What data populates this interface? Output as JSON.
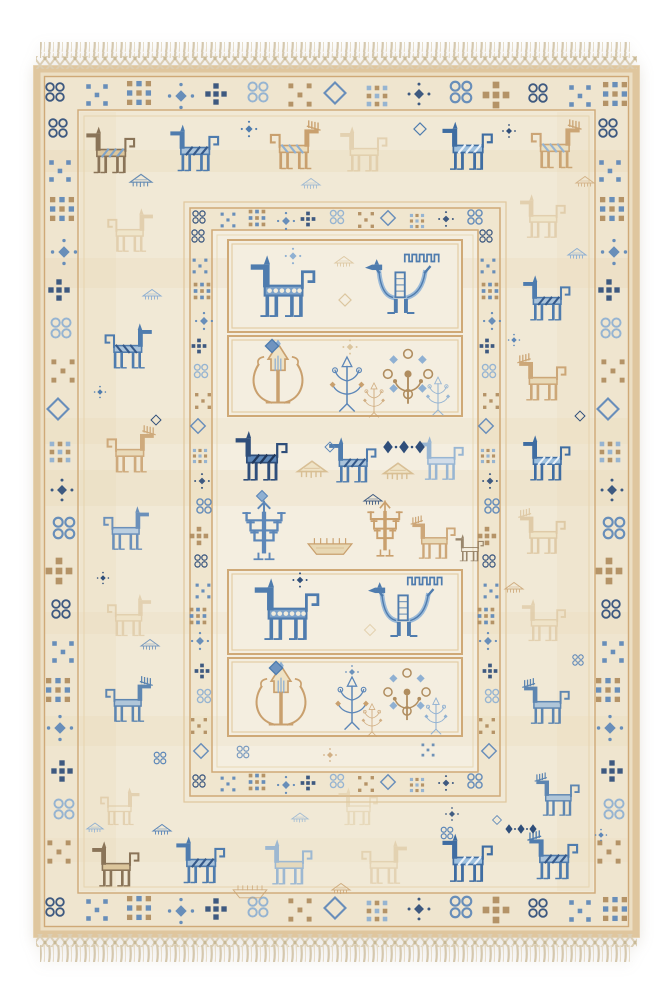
{
  "palette": {
    "page_bg": "#ffffff",
    "rug_edge_tan": "#dfc69e",
    "rug_base_cream": "#efe5cf",
    "band_cream": "#f1e9d6",
    "field_cream": "#f4eee0",
    "frame_tan": "#cfa977",
    "motif_tan": "#c9a06e",
    "motif_pale_tan": "#d6bb8e",
    "motif_brown": "#8a7458",
    "motif_navy": "#2f4e7a",
    "motif_blue": "#4f7cae",
    "motif_light_blue": "#8fb0d2",
    "fringe_cream": "#d8ccb4"
  },
  "canvas": {
    "w": 672,
    "h": 1000
  },
  "rug": {
    "x": 33,
    "y": 65,
    "w": 607,
    "h": 873,
    "fringe": {
      "top": {
        "tassel": [
          40,
          42,
          593,
          16
        ],
        "mesh": [
          36,
          56,
          601,
          13
        ]
      },
      "bottom": {
        "mesh": [
          36,
          934,
          601,
          13
        ],
        "tassel": [
          40,
          945,
          593,
          17
        ]
      }
    }
  },
  "bgs": [
    {
      "x": 33,
      "y": 65,
      "w": 607,
      "h": 873,
      "c": "#ecdfc4"
    },
    {
      "x": 45,
      "y": 77,
      "w": 583,
      "h": 849,
      "c": "#efe5cf"
    },
    {
      "x": 78,
      "y": 110,
      "w": 517,
      "h": 783,
      "c": "#f1e9d6"
    },
    {
      "x": 190,
      "y": 208,
      "w": 310,
      "h": 588,
      "c": "#f0e6cf"
    },
    {
      "x": 212,
      "y": 230,
      "w": 266,
      "h": 542,
      "c": "#f4eee0"
    }
  ],
  "textures": [
    {
      "x": 45,
      "y": 150,
      "w": 583,
      "h": 22,
      "c": "#e2cda2",
      "o": 0.18
    },
    {
      "x": 45,
      "y": 258,
      "w": 583,
      "h": 30,
      "c": "#e6d3ab",
      "o": 0.22
    },
    {
      "x": 45,
      "y": 418,
      "w": 583,
      "h": 26,
      "c": "#e2cda2",
      "o": 0.15
    },
    {
      "x": 45,
      "y": 470,
      "w": 583,
      "h": 36,
      "c": "#e6d3ab",
      "o": 0.2
    },
    {
      "x": 45,
      "y": 612,
      "w": 583,
      "h": 22,
      "c": "#e9d8b5",
      "o": 0.2
    },
    {
      "x": 45,
      "y": 716,
      "w": 583,
      "h": 30,
      "c": "#e6d3ab",
      "o": 0.16
    },
    {
      "x": 45,
      "y": 838,
      "w": 583,
      "h": 24,
      "c": "#e9d8b5",
      "o": 0.18
    },
    {
      "x": 80,
      "y": 112,
      "w": 36,
      "h": 779,
      "c": "#e9d7b2",
      "o": 0.22
    },
    {
      "x": 557,
      "y": 112,
      "w": 36,
      "h": 779,
      "c": "#e9d7b2",
      "o": 0.2
    }
  ],
  "frames": [
    {
      "x": 37,
      "y": 69,
      "w": 599,
      "h": 865,
      "stroke": "#dfc69e",
      "sw": 7
    },
    {
      "x": 44.5,
      "y": 76.5,
      "w": 584,
      "h": 850,
      "stroke": "#cfa977",
      "sw": 1.4
    },
    {
      "x": 78,
      "y": 110,
      "w": 517,
      "h": 783,
      "stroke": "#cfa977",
      "sw": 1.4
    },
    {
      "x": 84,
      "y": 116,
      "w": 505,
      "h": 771,
      "stroke": "#e6d3ae",
      "sw": 1
    },
    {
      "x": 184,
      "y": 202,
      "w": 322,
      "h": 600,
      "stroke": "#e0c79c",
      "sw": 1.2
    },
    {
      "x": 190,
      "y": 208,
      "w": 310,
      "h": 588,
      "stroke": "#cfa977",
      "sw": 1.5
    },
    {
      "x": 212,
      "y": 230,
      "w": 266,
      "h": 542,
      "stroke": "#cfa977",
      "sw": 1.5
    },
    {
      "x": 217,
      "y": 235,
      "w": 256,
      "h": 532,
      "stroke": "#e8d8b4",
      "sw": 1
    }
  ],
  "panels": [
    {
      "x": 228,
      "y": 240,
      "w": 234,
      "h": 92
    },
    {
      "x": 228,
      "y": 336,
      "w": 234,
      "h": 80
    },
    {
      "x": 228,
      "y": 570,
      "w": 234,
      "h": 84
    },
    {
      "x": 228,
      "y": 658,
      "w": 234,
      "h": 78
    }
  ],
  "panelStyle": {
    "fill": "#f4eee0",
    "stroke": "#cfa977",
    "inner": "#e3cda4"
  },
  "geoSequence": [
    {
      "t": "circles4",
      "c": "#2f4e7a"
    },
    {
      "t": "xdots",
      "c": "#5d87b8"
    },
    {
      "t": "grid9",
      "c": "#b08d5f",
      "c3": "#5d87b8"
    },
    {
      "t": "star",
      "c": "#5d87b8"
    },
    {
      "t": "cross5",
      "c": "#2f4e7a"
    },
    {
      "t": "circles4",
      "c": "#8fb0d2"
    },
    {
      "t": "xdots",
      "c": "#b08d5f"
    },
    {
      "t": "diamond",
      "c": "#5d87b8"
    },
    {
      "t": "grid9",
      "c": "#8fb0d2",
      "c3": "#b08d5f"
    },
    {
      "t": "star",
      "c": "#2f4e7a"
    },
    {
      "t": "circles4",
      "c": "#5d87b8"
    },
    {
      "t": "cross5",
      "c": "#b08d5f"
    }
  ],
  "geoBands": [
    {
      "name": "outer-top",
      "orient": "h",
      "y": 94,
      "x0": 58,
      "x1": 620,
      "step": 40,
      "s": 0.9
    },
    {
      "name": "outer-bottom",
      "orient": "h",
      "y": 909,
      "x0": 58,
      "x1": 620,
      "step": 40,
      "s": 0.9
    },
    {
      "name": "outer-left",
      "orient": "v",
      "x": 61,
      "y0": 130,
      "y1": 886,
      "step": 40,
      "s": 0.9
    },
    {
      "name": "outer-right",
      "orient": "v",
      "x": 611,
      "y0": 130,
      "y1": 886,
      "step": 40,
      "s": 0.9
    },
    {
      "name": "inner-top",
      "orient": "h",
      "y": 219,
      "x0": 202,
      "x1": 490,
      "step": 27,
      "s": 0.62
    },
    {
      "name": "inner-bottom",
      "orient": "h",
      "y": 783,
      "x0": 202,
      "x1": 490,
      "step": 27,
      "s": 0.62
    },
    {
      "name": "inner-left",
      "orient": "v",
      "x": 201,
      "y0": 238,
      "y1": 766,
      "step": 27,
      "s": 0.62
    },
    {
      "name": "inner-right",
      "orient": "v",
      "x": 489,
      "y0": 238,
      "y1": 766,
      "step": 27,
      "s": 0.62
    }
  ],
  "motifs": [
    {
      "t": "horse",
      "x": 113,
      "y": 152,
      "s": 0.62,
      "c1": "#8a7458",
      "c2": "#dcc69c",
      "c3": "#7fa3c8"
    },
    {
      "t": "horse",
      "x": 197,
      "y": 150,
      "s": 0.62,
      "c1": "#4f7cae",
      "c2": "#aac3da",
      "c3": "#35598a"
    },
    {
      "t": "deer",
      "x": 292,
      "y": 148,
      "s": 0.62,
      "flip": true,
      "c1": "#c9a06e",
      "c2": "#ecdcba",
      "c3": "#8fb0d2"
    },
    {
      "t": "horse",
      "x": 366,
      "y": 151,
      "s": 0.6,
      "c1": "#d9bf94",
      "c2": "#f0e3c4",
      "o": 0.55
    },
    {
      "t": "horse",
      "x": 470,
      "y": 148,
      "s": 0.64,
      "c1": "#3f6da2",
      "c2": "#9ec0de",
      "c3": "#eaf1f7"
    },
    {
      "t": "deer",
      "x": 553,
      "y": 147,
      "s": 0.62,
      "flip": true,
      "c1": "#c9a06e",
      "c2": "#eadfc0",
      "c3": "#8fb0d2",
      "o": 0.92
    },
    {
      "t": "awning",
      "x": 141,
      "y": 181,
      "s": 0.6,
      "c1": "#4f7cae",
      "o": 0.85
    },
    {
      "t": "star",
      "x": 249,
      "y": 129,
      "s": 0.6,
      "c1": "#4f7cae"
    },
    {
      "t": "awning",
      "x": 311,
      "y": 184,
      "s": 0.5,
      "c1": "#8fb0d2",
      "o": 0.8
    },
    {
      "t": "diamond",
      "x": 420,
      "y": 129,
      "s": 0.55,
      "c1": "#4f7cae"
    },
    {
      "t": "star",
      "x": 509,
      "y": 131,
      "s": 0.5,
      "c1": "#2f4e7a"
    },
    {
      "t": "awning",
      "x": 585,
      "y": 182,
      "s": 0.5,
      "c1": "#c9a06e",
      "o": 0.7
    },
    {
      "t": "horse",
      "x": 128,
      "y": 232,
      "s": 0.58,
      "flip": true,
      "c1": "#d6bb8e",
      "c2": "#efe2c2",
      "o": 0.55
    },
    {
      "t": "horse",
      "x": 126,
      "y": 348,
      "s": 0.6,
      "flip": true,
      "c1": "#4f7cae",
      "c2": "#aac3da",
      "c3": "#35598a"
    },
    {
      "t": "deer",
      "x": 128,
      "y": 452,
      "s": 0.6,
      "flip": true,
      "c1": "#c9a06e",
      "c2": "#e8d8b4",
      "o": 0.85
    },
    {
      "t": "horse",
      "x": 124,
      "y": 530,
      "s": 0.58,
      "flip": true,
      "c1": "#5d87b8",
      "c2": "#b7cde2",
      "o": 0.9
    },
    {
      "t": "horse",
      "x": 127,
      "y": 617,
      "s": 0.56,
      "flip": true,
      "c1": "#d6bb8e",
      "c2": "#efe2c2",
      "o": 0.5
    },
    {
      "t": "deer",
      "x": 126,
      "y": 702,
      "s": 0.58,
      "flip": true,
      "c1": "#4f7cae",
      "c2": "#aac3da",
      "o": 0.9
    },
    {
      "t": "horse",
      "x": 118,
      "y": 808,
      "s": 0.5,
      "flip": true,
      "c1": "#d6bb8e",
      "o": 0.5
    },
    {
      "t": "awning",
      "x": 152,
      "y": 295,
      "s": 0.5,
      "c1": "#8fb0d2"
    },
    {
      "t": "star",
      "x": 100,
      "y": 392,
      "s": 0.45,
      "c1": "#4f7cae"
    },
    {
      "t": "diamond",
      "x": 156,
      "y": 420,
      "s": 0.45,
      "c1": "#2f4e7a"
    },
    {
      "t": "awning",
      "x": 150,
      "y": 645,
      "s": 0.5,
      "c1": "#5d87b8",
      "o": 0.8
    },
    {
      "t": "star",
      "x": 103,
      "y": 578,
      "s": 0.45,
      "c1": "#2f4e7a"
    },
    {
      "t": "circles4",
      "x": 160,
      "y": 758,
      "s": 0.5,
      "c1": "#5d87b8"
    },
    {
      "t": "horse",
      "x": 545,
      "y": 218,
      "s": 0.58,
      "c1": "#d6bb8e",
      "c2": "#efe2c2",
      "o": 0.55
    },
    {
      "t": "horse",
      "x": 549,
      "y": 300,
      "s": 0.6,
      "c1": "#4f7cae",
      "c2": "#aac3da",
      "c3": "#35598a"
    },
    {
      "t": "deer",
      "x": 545,
      "y": 380,
      "s": 0.6,
      "c1": "#c9a06e",
      "c2": "#e8d8b4",
      "o": 0.9
    },
    {
      "t": "horse",
      "x": 549,
      "y": 460,
      "s": 0.6,
      "c1": "#3f6da2",
      "c2": "#9ec0de",
      "c3": "#eaf1f7"
    },
    {
      "t": "deer",
      "x": 545,
      "y": 534,
      "s": 0.58,
      "c1": "#d6bb8e",
      "c2": "#efe2c2",
      "o": 0.65
    },
    {
      "t": "horse",
      "x": 546,
      "y": 622,
      "s": 0.56,
      "c1": "#d6bb8e",
      "c2": "#efe2c2",
      "o": 0.5
    },
    {
      "t": "deer",
      "x": 549,
      "y": 704,
      "s": 0.58,
      "c1": "#4f7cae",
      "c2": "#aac3da",
      "o": 0.9
    },
    {
      "t": "deer",
      "x": 560,
      "y": 797,
      "s": 0.55,
      "c1": "#4f7cae",
      "c2": "#aac3da",
      "o": 0.9
    },
    {
      "t": "awning",
      "x": 577,
      "y": 254,
      "s": 0.5,
      "c1": "#8fb0d2"
    },
    {
      "t": "star",
      "x": 514,
      "y": 340,
      "s": 0.45,
      "c1": "#5d87b8"
    },
    {
      "t": "diamond",
      "x": 580,
      "y": 416,
      "s": 0.45,
      "c1": "#2f4e7a"
    },
    {
      "t": "awning",
      "x": 514,
      "y": 588,
      "s": 0.5,
      "c1": "#c9a06e",
      "o": 0.8
    },
    {
      "t": "circles4",
      "x": 578,
      "y": 660,
      "s": 0.45,
      "c1": "#5d87b8"
    },
    {
      "t": "horse",
      "x": 118,
      "y": 866,
      "s": 0.6,
      "c1": "#8a7458",
      "c2": "#dcc69c"
    },
    {
      "t": "horse",
      "x": 203,
      "y": 862,
      "s": 0.62,
      "c1": "#4f7cae",
      "c2": "#aac3da",
      "c3": "#35598a"
    },
    {
      "t": "horse",
      "x": 291,
      "y": 864,
      "s": 0.6,
      "c1": "#8fb0d2",
      "c2": "#e4d7b8",
      "o": 0.85
    },
    {
      "t": "horse",
      "x": 382,
      "y": 864,
      "s": 0.58,
      "flip": true,
      "c1": "#d9bf94",
      "c2": "#f0e3c4",
      "o": 0.5
    },
    {
      "t": "horse",
      "x": 470,
      "y": 860,
      "s": 0.64,
      "c1": "#3f6da2",
      "c2": "#9ec0de",
      "c3": "#eaf1f7"
    },
    {
      "t": "deer",
      "x": 556,
      "y": 858,
      "s": 0.62,
      "c1": "#4f7cae",
      "c2": "#aac3da",
      "c3": "#35598a"
    },
    {
      "t": "awning",
      "x": 162,
      "y": 830,
      "s": 0.5,
      "c1": "#5d87b8"
    },
    {
      "t": "circles4",
      "x": 447,
      "y": 833,
      "s": 0.5,
      "c1": "#5d87b8"
    },
    {
      "t": "diamonds3",
      "x": 521,
      "y": 829,
      "s": 0.6,
      "c1": "#2f4e7a"
    },
    {
      "t": "boat",
      "x": 250,
      "y": 893,
      "s": 0.4,
      "c1": "#c9a06e",
      "o": 0.8
    },
    {
      "t": "awning",
      "x": 341,
      "y": 889,
      "s": 0.5,
      "c1": "#c9a06e",
      "o": 0.8
    },
    {
      "t": "awning",
      "x": 95,
      "y": 828,
      "s": 0.45,
      "c1": "#8fb0d2"
    },
    {
      "t": "star",
      "x": 601,
      "y": 835,
      "s": 0.45,
      "c1": "#5d87b8"
    },
    {
      "t": "horse",
      "x": 360,
      "y": 808,
      "s": 0.5,
      "c1": "#ddc69c",
      "o": 0.45
    },
    {
      "t": "awning",
      "x": 300,
      "y": 818,
      "s": 0.45,
      "c1": "#8fb0d2",
      "o": 0.8
    },
    {
      "t": "star",
      "x": 452,
      "y": 814,
      "s": 0.5,
      "c1": "#2f4e7a",
      "o": 0.9
    },
    {
      "t": "diamond",
      "x": 497,
      "y": 820,
      "s": 0.4,
      "c1": "#5d87b8"
    },
    {
      "t": "circles4",
      "x": 243,
      "y": 752,
      "s": 0.5,
      "c1": "#5d87b8",
      "o": 0.8
    },
    {
      "t": "star",
      "x": 330,
      "y": 755,
      "s": 0.5,
      "c1": "#c9a06e",
      "o": 0.8
    },
    {
      "t": "xdots",
      "x": 428,
      "y": 750,
      "s": 0.5,
      "c1": "#4f7cae",
      "o": 0.8
    },
    {
      "t": "horseOrnate",
      "x": 286,
      "y": 289,
      "s": 0.82,
      "c1": "#4f7cae",
      "c2": "#7da2c9",
      "c3": "#f2ecdc"
    },
    {
      "t": "eagle",
      "x": 404,
      "y": 288,
      "s": 0.78,
      "c1": "#4f7cae",
      "c2": "#9bbad8"
    },
    {
      "t": "star",
      "x": 293,
      "y": 256,
      "s": 0.6,
      "c1": "#8fb0d2"
    },
    {
      "t": "diamond",
      "x": 345,
      "y": 300,
      "s": 0.55,
      "c1": "#d6bb8e",
      "o": 0.8
    },
    {
      "t": "awning",
      "x": 344,
      "y": 262,
      "s": 0.5,
      "c1": "#d6bb8e",
      "o": 0.7
    },
    {
      "t": "tulip",
      "x": 278,
      "y": 378,
      "s": 0.7,
      "c1": "#c9a06e",
      "c2": "#efe2c4",
      "c3": "#8fb0d2"
    },
    {
      "t": "diamond",
      "x": 272,
      "y": 346,
      "s": 0.6,
      "c1": "#4f7cae",
      "c2": "#6f94c0"
    },
    {
      "t": "spray",
      "x": 347,
      "y": 384,
      "s": 0.6,
      "c1": "#5d87b8",
      "c3": "#c9a06e"
    },
    {
      "t": "rosette",
      "x": 408,
      "y": 374,
      "s": 0.72,
      "c1": "#b08d5f",
      "c3": "#8fb0d2"
    },
    {
      "t": "spray",
      "x": 438,
      "y": 396,
      "s": 0.42,
      "c1": "#8fb0d2",
      "o": 0.9
    },
    {
      "t": "spray",
      "x": 374,
      "y": 400,
      "s": 0.38,
      "c1": "#c9a06e",
      "o": 0.8
    },
    {
      "t": "star",
      "x": 350,
      "y": 347,
      "s": 0.55,
      "c1": "#d6bb8e",
      "o": 0.8
    },
    {
      "t": "horse",
      "x": 264,
      "y": 458,
      "s": 0.66,
      "c1": "#2f4e7a",
      "c2": "#5d87b8",
      "c3": "#20385c"
    },
    {
      "t": "horse",
      "x": 355,
      "y": 462,
      "s": 0.6,
      "c1": "#4f7cae",
      "c2": "#aac3da",
      "c3": "#35598a"
    },
    {
      "t": "horse",
      "x": 443,
      "y": 460,
      "s": 0.58,
      "c1": "#8fb0d2",
      "c2": "#cfdcea",
      "o": 0.9
    },
    {
      "t": "awning",
      "x": 312,
      "y": 470,
      "s": 0.8,
      "c1": "#d6bb8e",
      "c2": "#efe2c4",
      "o": 0.9
    },
    {
      "t": "awning",
      "x": 398,
      "y": 472,
      "s": 0.8,
      "c1": "#d6bb8e",
      "c2": "#efe2c4",
      "o": 0.9
    },
    {
      "t": "diamonds3",
      "x": 404,
      "y": 447,
      "s": 0.8,
      "c1": "#2f4e7a"
    },
    {
      "t": "diamond",
      "x": 330,
      "y": 447,
      "s": 0.45,
      "c1": "#5d87b8"
    },
    {
      "t": "awning",
      "x": 373,
      "y": 500,
      "s": 0.5,
      "c1": "#2f4e7a",
      "o": 0.9
    },
    {
      "t": "diamond",
      "x": 262,
      "y": 496,
      "s": 0.5,
      "c1": "#5d87b8",
      "c2": "#8fb0d2"
    },
    {
      "t": "candelabra",
      "x": 264,
      "y": 534,
      "s": 0.72,
      "sx": 1.1,
      "c1": "#5d87b8"
    },
    {
      "t": "boat",
      "x": 330,
      "y": 548,
      "s": 0.52,
      "c1": "#c9a06e",
      "c2": "#e8d8b4"
    },
    {
      "t": "candelabra",
      "x": 385,
      "y": 532,
      "s": 0.68,
      "sx": 0.95,
      "c1": "#c9a06e"
    },
    {
      "t": "deer",
      "x": 436,
      "y": 540,
      "s": 0.55,
      "c1": "#c9a06e",
      "c2": "#e8d8b4",
      "o": 0.9
    },
    {
      "t": "horse",
      "x": 471,
      "y": 549,
      "s": 0.36,
      "c1": "#8a7458",
      "o": 0.85
    },
    {
      "t": "horseOrnate",
      "x": 290,
      "y": 612,
      "s": 0.82,
      "c1": "#4f7cae",
      "c2": "#7da2c9",
      "c3": "#f2ecdc"
    },
    {
      "t": "eagle",
      "x": 407,
      "y": 611,
      "s": 0.78,
      "c1": "#4f7cae",
      "c2": "#9bbad8"
    },
    {
      "t": "star",
      "x": 300,
      "y": 580,
      "s": 0.55,
      "c1": "#2f4e7a"
    },
    {
      "t": "diamond",
      "x": 370,
      "y": 630,
      "s": 0.5,
      "c1": "#ddc69c",
      "o": 0.7
    },
    {
      "t": "tulip",
      "x": 281,
      "y": 700,
      "s": 0.7,
      "c1": "#c9a06e",
      "c2": "#efe2c4",
      "c3": "#8fb0d2"
    },
    {
      "t": "diamond",
      "x": 276,
      "y": 668,
      "s": 0.6,
      "c1": "#4f7cae",
      "c2": "#6f94c0"
    },
    {
      "t": "spray",
      "x": 352,
      "y": 703,
      "s": 0.58,
      "c1": "#5d87b8",
      "c3": "#c9a06e"
    },
    {
      "t": "rosette",
      "x": 407,
      "y": 692,
      "s": 0.68,
      "c1": "#b08d5f",
      "c3": "#8fb0d2"
    },
    {
      "t": "spray",
      "x": 436,
      "y": 716,
      "s": 0.4,
      "c1": "#8fb0d2"
    },
    {
      "t": "spray",
      "x": 372,
      "y": 720,
      "s": 0.36,
      "c1": "#c9a06e",
      "o": 0.8
    },
    {
      "t": "star",
      "x": 352,
      "y": 672,
      "s": 0.5,
      "c1": "#5d87b8",
      "o": 0.9
    }
  ]
}
